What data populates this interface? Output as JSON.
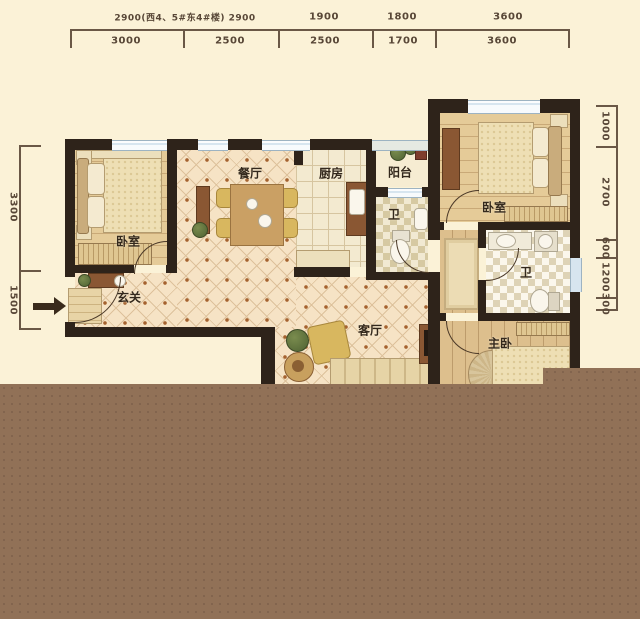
{
  "dimensions": {
    "top_row1": [
      "2900(西4、5#东4#楼) 2900",
      "1900",
      "1800",
      "3600"
    ],
    "top_row2": [
      "3000",
      "2500",
      "2500",
      "1700",
      "3600"
    ],
    "left": [
      "3300",
      "1500"
    ],
    "right": [
      "1000",
      "2700",
      "600",
      "1200",
      "300"
    ]
  },
  "rooms": {
    "bedroom_left": "卧室",
    "dining": "餐厅",
    "kitchen": "厨房",
    "balcony": "阳台",
    "bath_middle": "卫",
    "bedroom_right": "卧室",
    "bath_right": "卫",
    "foyer": "玄关",
    "living": "客厅",
    "master": "主卧"
  },
  "colors": {
    "background": "#fbf2d7",
    "wall": "#2e231a",
    "window": "#d7e5ef",
    "tile_base": "#f6e3c5",
    "bottom_block": "#917157"
  }
}
